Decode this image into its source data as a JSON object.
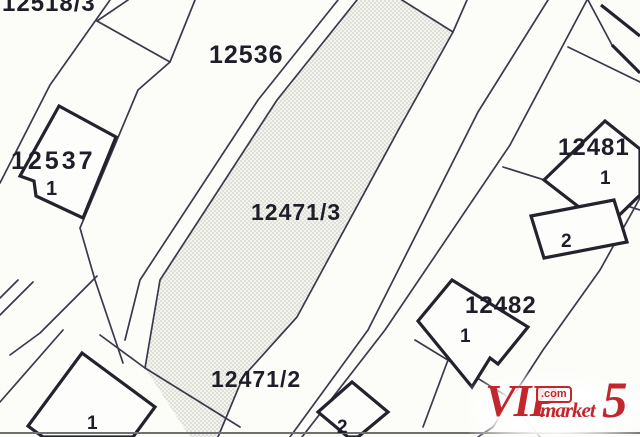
{
  "map": {
    "background": "#fcfcf9",
    "colors": {
      "line": "#3a3a4c",
      "building": "#23232e",
      "label": "#1e1e29",
      "building_fill": "#fdfdfb",
      "stipple_dot": "#b7b7ae",
      "stipple_bg": "#f4f4ee",
      "bottom_rule": "#707070"
    },
    "labels": [
      {
        "name": "parcel-label-12518-3",
        "text": "12518/3",
        "x": 2,
        "y": 11,
        "size": 24,
        "ls": 1
      },
      {
        "name": "parcel-label-12536",
        "text": "12536",
        "x": 209,
        "y": 63,
        "size": 25,
        "ls": 1
      },
      {
        "name": "parcel-label-12537",
        "text": "12537",
        "x": 11,
        "y": 169,
        "size": 25,
        "ls": 3
      },
      {
        "name": "building-label-12537-1",
        "text": "1",
        "x": 46,
        "y": 195,
        "size": 20,
        "ls": 0
      },
      {
        "name": "parcel-label-12471-3",
        "text": "12471/3",
        "x": 251,
        "y": 220,
        "size": 23,
        "ls": 1
      },
      {
        "name": "parcel-label-12471-2",
        "text": "12471/2",
        "x": 211,
        "y": 387,
        "size": 23,
        "ls": 1
      },
      {
        "name": "parcel-label-12481",
        "text": "12481",
        "x": 558,
        "y": 155,
        "size": 24,
        "ls": 1
      },
      {
        "name": "building-label-12481-1",
        "text": "1",
        "x": 600,
        "y": 184,
        "size": 19,
        "ls": 0
      },
      {
        "name": "building-label-12481-2",
        "text": "2",
        "x": 561,
        "y": 247,
        "size": 19,
        "ls": 0
      },
      {
        "name": "parcel-label-12482",
        "text": "12482",
        "x": 465,
        "y": 313,
        "size": 24,
        "ls": 1
      },
      {
        "name": "building-label-12482-1",
        "text": "1",
        "x": 460,
        "y": 342,
        "size": 19,
        "ls": 0
      },
      {
        "name": "building-label-bottomleft-1",
        "text": "1",
        "x": 87,
        "y": 429,
        "size": 19,
        "ls": 0
      },
      {
        "name": "building-label-bottom-2",
        "text": "2",
        "x": 337,
        "y": 433,
        "size": 19,
        "ls": 0
      }
    ],
    "stipple_parcel": {
      "name": "parcel-12471-hatched-strip",
      "points": [
        [
          357,
          0
        ],
        [
          402,
          0
        ],
        [
          453,
          32
        ],
        [
          400,
          127
        ],
        [
          297,
          317
        ],
        [
          243,
          377
        ],
        [
          218,
          437
        ],
        [
          190,
          437
        ],
        [
          145,
          368
        ],
        [
          160,
          280
        ],
        [
          277,
          100
        ]
      ]
    },
    "boundary_lines": [
      {
        "name": "boundary-left-road-west",
        "pts": [
          [
            110,
            0
          ],
          [
            50,
            85
          ],
          [
            0,
            183
          ]
        ]
      },
      {
        "name": "boundary-12518-notch-a",
        "pts": [
          [
            128,
            0
          ],
          [
            97,
            21
          ]
        ]
      },
      {
        "name": "boundary-12518-notch-b",
        "pts": [
          [
            97,
            21
          ],
          [
            170,
            62
          ]
        ]
      },
      {
        "name": "boundary-12537-parcel-east",
        "pts": [
          [
            195,
            0
          ],
          [
            170,
            62
          ],
          [
            138,
            90
          ],
          [
            80,
            228
          ],
          [
            95,
            280
          ],
          [
            123,
            363
          ]
        ]
      },
      {
        "name": "boundary-southwest-a",
        "pts": [
          [
            63,
            330
          ],
          [
            0,
            402
          ]
        ]
      },
      {
        "name": "boundary-southwest-b",
        "pts": [
          [
            18,
            280
          ],
          [
            0,
            298
          ]
        ]
      },
      {
        "name": "boundary-southwest-c",
        "pts": [
          [
            33,
            282
          ],
          [
            0,
            315
          ]
        ]
      },
      {
        "name": "boundary-southwest-d",
        "pts": [
          [
            97,
            276
          ],
          [
            40,
            333
          ],
          [
            10,
            355
          ]
        ]
      },
      {
        "name": "boundary-12471-division",
        "pts": [
          [
            100,
            335
          ],
          [
            145,
            368
          ],
          [
            240,
            427
          ]
        ]
      },
      {
        "name": "boundary-road-outer-west",
        "pts": [
          [
            338,
            0
          ],
          [
            258,
            100
          ],
          [
            140,
            280
          ],
          [
            125,
            340
          ]
        ]
      },
      {
        "name": "boundary-strip-west",
        "pts": [
          [
            357,
            0
          ],
          [
            277,
            100
          ],
          [
            160,
            280
          ],
          [
            145,
            368
          ]
        ]
      },
      {
        "name": "boundary-strip-east",
        "pts": [
          [
            402,
            0
          ],
          [
            453,
            32
          ],
          [
            400,
            127
          ],
          [
            297,
            317
          ],
          [
            243,
            377
          ],
          [
            218,
            437
          ]
        ]
      },
      {
        "name": "boundary-strip-east-top",
        "pts": [
          [
            467,
            0
          ],
          [
            453,
            32
          ]
        ]
      },
      {
        "name": "boundary-road-east-1",
        "pts": [
          [
            548,
            0
          ],
          [
            478,
            112
          ],
          [
            368,
            330
          ],
          [
            290,
            437
          ]
        ]
      },
      {
        "name": "boundary-road-east-2",
        "pts": [
          [
            587,
            0
          ],
          [
            510,
            145
          ],
          [
            385,
            330
          ],
          [
            302,
            437
          ]
        ]
      },
      {
        "name": "boundary-12481-12482",
        "pts": [
          [
            503,
            167
          ],
          [
            640,
            210
          ]
        ]
      },
      {
        "name": "boundary-northeast-a",
        "pts": [
          [
            568,
            47
          ],
          [
            640,
            82
          ]
        ]
      },
      {
        "name": "boundary-northeast-b",
        "pts": [
          [
            588,
            0
          ],
          [
            612,
            45
          ]
        ]
      },
      {
        "name": "boundary-east-parcels",
        "pts": [
          [
            640,
            198
          ],
          [
            600,
            270
          ],
          [
            543,
            350
          ],
          [
            493,
            427
          ],
          [
            478,
            437
          ]
        ]
      },
      {
        "name": "boundary-south-center",
        "pts": [
          [
            415,
            340
          ],
          [
            505,
            395
          ],
          [
            540,
            437
          ]
        ]
      },
      {
        "name": "boundary-south-12482",
        "pts": [
          [
            448,
            360
          ],
          [
            423,
            427
          ]
        ]
      }
    ],
    "buildings": [
      {
        "name": "building-12537-1",
        "points": [
          [
            59,
            106
          ],
          [
            116,
            137
          ],
          [
            83,
            218
          ],
          [
            36,
            196
          ],
          [
            34,
            181
          ],
          [
            20,
            176
          ]
        ],
        "closed": true
      },
      {
        "name": "building-bottomleft-1",
        "points": [
          [
            82,
            353
          ],
          [
            155,
            407
          ],
          [
            133,
            437
          ],
          [
            43,
            437
          ],
          [
            28,
            426
          ]
        ],
        "closed": true
      },
      {
        "name": "building-bottom-2",
        "points": [
          [
            352,
            382
          ],
          [
            388,
            412
          ],
          [
            358,
            437
          ],
          [
            348,
            437
          ],
          [
            318,
            412
          ]
        ],
        "closed": true
      },
      {
        "name": "building-12481-1",
        "points": [
          [
            605,
            121
          ],
          [
            640,
            149
          ],
          [
            640,
            195
          ],
          [
            606,
            228
          ],
          [
            544,
            180
          ]
        ],
        "closed": true
      },
      {
        "name": "building-12481-2",
        "points": [
          [
            531,
            216
          ],
          [
            614,
            200
          ],
          [
            627,
            242
          ],
          [
            544,
            258
          ]
        ],
        "closed": true
      },
      {
        "name": "building-12482-1",
        "points": [
          [
            452,
            280
          ],
          [
            528,
            327
          ],
          [
            498,
            364
          ],
          [
            490,
            358
          ],
          [
            472,
            387
          ],
          [
            418,
            321
          ]
        ],
        "closed": true
      },
      {
        "name": "building-northeast-corner-a",
        "points": [
          [
            601,
            5
          ],
          [
            640,
            36
          ]
        ],
        "closed": false
      },
      {
        "name": "building-northeast-corner-b",
        "points": [
          [
            612,
            45
          ],
          [
            640,
            73
          ]
        ],
        "closed": false
      }
    ],
    "bottom_rule_y": 433
  },
  "watermark": {
    "vip": "VIP",
    "com": ".com",
    "market": "market",
    "five": "5",
    "color": "#c1272d"
  }
}
